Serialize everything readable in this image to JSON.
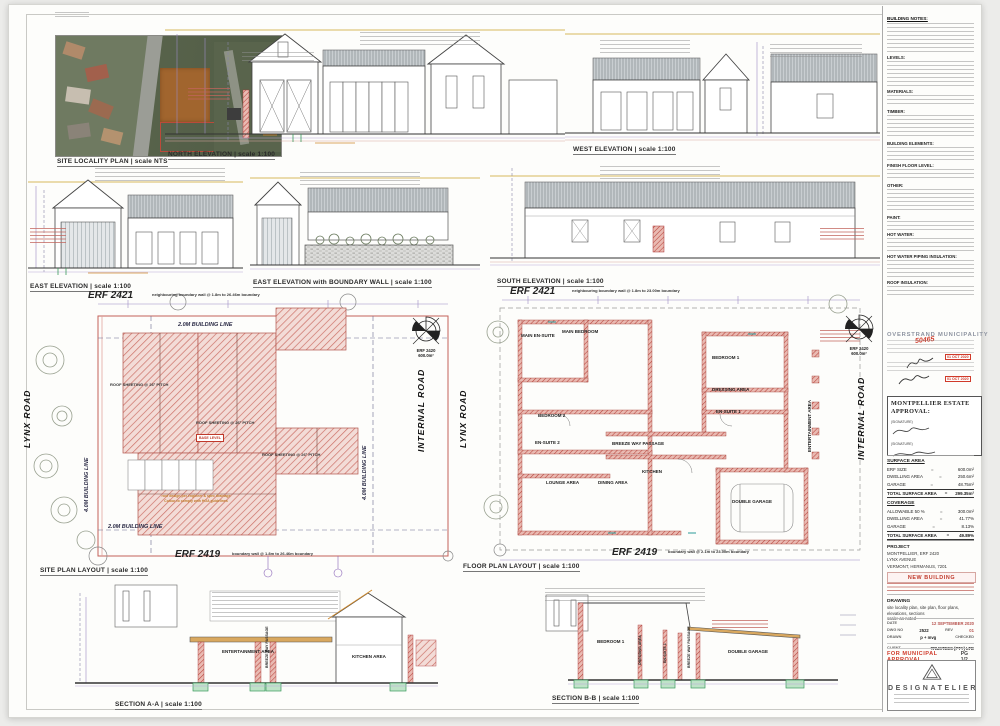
{
  "captions": {
    "site_locality": "SITE LOCALITY PLAN | scale NTS",
    "north": "NORTH ELEVATION | scale 1:100",
    "west": "WEST ELEVATION | scale 1:100",
    "east": "EAST ELEVATION | scale 1:100",
    "east_boundary": "EAST ELEVATION with BOUNDARY WALL | scale 1:100",
    "south": "SOUTH ELEVATION | scale 1:100",
    "site_plan": "SITE PLAN LAYOUT | scale 1:100",
    "floor_plan": "FLOOR PLAN LAYOUT | scale 1:100",
    "section_a": "SECTION A-A | scale 1:100",
    "section_b": "SECTION B-B | scale 1:100"
  },
  "site_plan": {
    "erf_top": "ERF 2421",
    "erf_top_note": "neighbouring boundary wall @ 1.8m to 26.46m boundary",
    "erf_bottom": "ERF 2419",
    "erf_bottom_note": "boundary wall @ 1.8m to 26.46m boundary",
    "road_left": "LYNX ROAD",
    "road_right": "INTERNAL ROAD",
    "building_line_top": "2.0M BUILDING LINE",
    "building_line_left": "4.0M BUILDING LINE",
    "building_line_bottom": "2.0M BUILDING LINE",
    "building_line_right": "4.0M BUILDING LINE",
    "roof_label": "ROOF SHEETING @ 26° PITCH",
    "base_level": "BASE LEVEL",
    "roof_note_1": "roof design per engineer & spec drainage",
    "roof_note_2": "Colour to comply with HOA guidelines"
  },
  "floor_plan": {
    "erf_top": "ERF 2421",
    "erf_top_note": "neighbouring boundary wall @ 1.8m to 23.00m boundary",
    "erf_bottom": "ERF 2419",
    "erf_bottom_note": "boundary wall @ 2.1m to 23.00m boundary",
    "road_left": "LYNX ROAD",
    "road_right": "INTERNAL ROAD",
    "rooms": {
      "main_ensuite": "MAIN EN-SUITE",
      "main_bedroom": "MAIN BEDROOM",
      "bedroom2": "BEDROOM 2",
      "ensuite2": "EN-SUITE 2",
      "lounge": "LOUNGE AREA",
      "dining": "DINING AREA",
      "kitchen": "KITCHEN",
      "breezeway": "BREEZE WAY PASSAGE",
      "bedroom1": "BEDROOM 1",
      "dressing": "DRESSING AREA",
      "ensuite1": "EN-SUITE 1",
      "entertainment": "ENTERTAINMENT AREA",
      "garage": "DOUBLE GARAGE"
    }
  },
  "compass": {
    "erf": "ERF 2420",
    "area": "600.0m²",
    "north_letter": "N"
  },
  "sections": {
    "a": {
      "entertainment": "ENTERTAINMENT AREA",
      "breezeway": "BREEZE WAY PASSAGE",
      "kitchen": "KITCHEN AREA"
    },
    "b": {
      "bedroom1": "BEDROOM 1",
      "dressing": "DRESSING AREA",
      "ensuite1": "EN-SUITE 1",
      "breezeway": "BREEZE WAY PASSAGE",
      "garage": "DOUBLE GARAGE"
    }
  },
  "notes": {
    "title": "BUILDING NOTES:",
    "sections": [
      {
        "heading": "LEVELS:"
      },
      {
        "heading": "MATERIALS:"
      },
      {
        "heading": "TIMBER:"
      },
      {
        "heading": "BUILDING ELEMENTS:"
      },
      {
        "heading": "FINISH FLOOR LEVEL:"
      },
      {
        "heading": "OTHER:"
      },
      {
        "heading": "PAINT:"
      },
      {
        "heading": "HOT WATER:"
      },
      {
        "heading": "HOT WATER PIPING INSULATION:"
      },
      {
        "heading": "ROOF INSULATION:"
      }
    ]
  },
  "stamp": {
    "municipality": "OVERSTRAND MUNICIPALITY",
    "plan_no": "50465",
    "date_label_1": "Date:",
    "date_label_2": "Date:",
    "date_stamp_1": "01 OCT 2020",
    "date_stamp_2": "01 OCT 2020"
  },
  "estate": {
    "title": "MONTPELLIER ESTATE APPROVAL:",
    "signature_label_1": "(SIGNATURE)",
    "signature_label_2": "(SIGNATURE)"
  },
  "surface_area": {
    "title": "SURFACE AREA",
    "rows": [
      {
        "label": "ERF SIZE",
        "eq": "=",
        "value": "600.0m²"
      },
      {
        "label": "DWELLING AREA",
        "eq": "=",
        "value": "250.6m²"
      },
      {
        "label": "GARAGE",
        "eq": "=",
        "value": "48.75m²"
      },
      {
        "label": "TOTAL SURFACE AREA",
        "eq": "=",
        "value": "299.35m²"
      }
    ]
  },
  "coverage": {
    "title": "COVERAGE",
    "rows": [
      {
        "label": "ALLOWABLE 50 %",
        "eq": "=",
        "value": "300.0m²"
      },
      {
        "label": "DWELLING AREA",
        "eq": "=",
        "value": "41.77%"
      },
      {
        "label": "GARAGE",
        "eq": "=",
        "value": "8.13%"
      },
      {
        "label": "TOTAL SURFACE AREA",
        "eq": "=",
        "value": "49.89%"
      }
    ]
  },
  "project": {
    "title": "PROJECT",
    "line1": "MONTPELLIER, ERF 2420",
    "line2": "LYNX AVENUE",
    "line3": "VERMONT, HERMANUS, 7201",
    "status": "NEW BUILDING"
  },
  "drawing_info": {
    "title": "DRAWING",
    "items": "site locality plan, site plan, floor plans, elevations, sections",
    "scale": "scale: as noted"
  },
  "titleblock": {
    "date_label": "DATE",
    "date_value": "12 SEPTEMBER 2020",
    "dwg_label": "DWG NO",
    "dwg_value": "2522",
    "rev_label": "REV",
    "rev_value": "01",
    "drawn_label": "DRAWN",
    "drawn_value": "p + mvg",
    "checked_label": "CHECKED",
    "client_label": "CLIENT",
    "client_value": "TRUSTEES (PTY) LTD",
    "approval": "FOR MUNICIPAL APPROVAL",
    "page": "PG 1/2"
  },
  "logo": {
    "name": "DESIGNATELIER"
  }
}
